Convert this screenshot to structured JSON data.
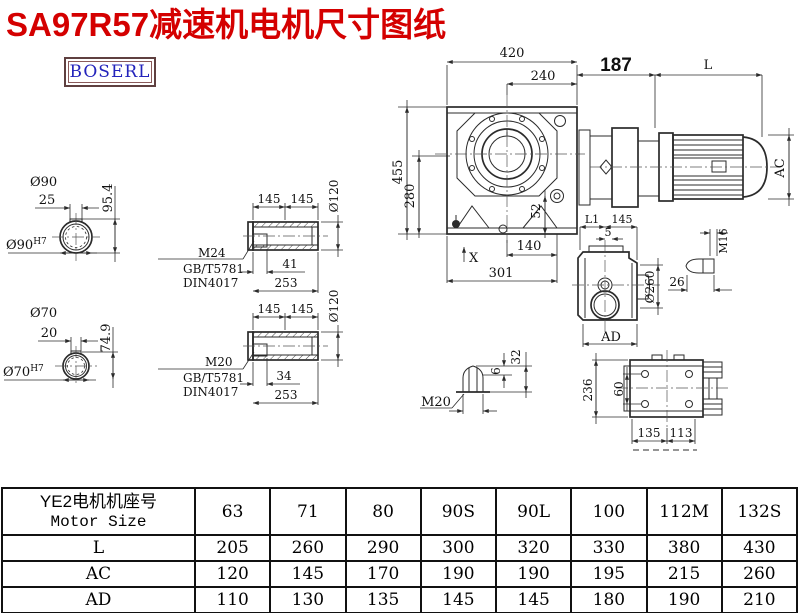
{
  "title": "SA97R57减速机电机尺寸图纸",
  "brand": {
    "logo_text": "BOSERL"
  },
  "colors": {
    "title": "#d40000",
    "logo_text": "#2323bb",
    "logo_border": "#5f4040",
    "line": "#2b2b2b"
  },
  "drawings": {
    "hole90": {
      "dia": "Ø90",
      "len": "25",
      "h": "95.4",
      "bore": "Ø90",
      "tol": "H7"
    },
    "hole70": {
      "dia": "Ø70",
      "len": "20",
      "h": "74.9",
      "bore": "Ø70",
      "tol": "H7"
    },
    "shaftTop": {
      "d1": "145",
      "d2": "145",
      "dia": "Ø120",
      "thread": "M24",
      "std1": "GB/T5781",
      "std2": "DIN4017",
      "l1": "41",
      "l2": "253"
    },
    "shaftBot": {
      "d1": "145",
      "d2": "145",
      "dia": "Ø120",
      "thread": "M20",
      "std1": "GB/T5781",
      "std2": "DIN4017",
      "l1": "34",
      "l2": "253"
    },
    "front": {
      "w": "420",
      "w2": "240",
      "h": "455",
      "h2": "280",
      "d52": "52",
      "x": "X",
      "d140": "140",
      "d301": "301"
    },
    "motor": {
      "d187": "187",
      "l": "L",
      "ac": "AC"
    },
    "side": {
      "l1": "L1",
      "d145": "145",
      "d5": "5",
      "dia": "Ø260",
      "ad": "AD",
      "m16": "M16",
      "d26": "26"
    },
    "plug": {
      "d32": "32",
      "d6": "6",
      "m20": "M20"
    },
    "rear": {
      "d236": "236",
      "d60": "60",
      "d135": "135",
      "d113": "113"
    }
  },
  "table": {
    "header": {
      "line1": "YE2电机机座号",
      "line2": "Motor Size"
    },
    "sizes": [
      "63",
      "71",
      "80",
      "90S",
      "90L",
      "100",
      "112M",
      "132S"
    ],
    "rows": [
      {
        "label": "L",
        "values": [
          "205",
          "260",
          "290",
          "300",
          "320",
          "330",
          "380",
          "430"
        ]
      },
      {
        "label": "AC",
        "values": [
          "120",
          "145",
          "170",
          "190",
          "190",
          "195",
          "215",
          "260"
        ]
      },
      {
        "label": "AD",
        "values": [
          "110",
          "130",
          "135",
          "145",
          "145",
          "180",
          "190",
          "210"
        ]
      }
    ]
  }
}
